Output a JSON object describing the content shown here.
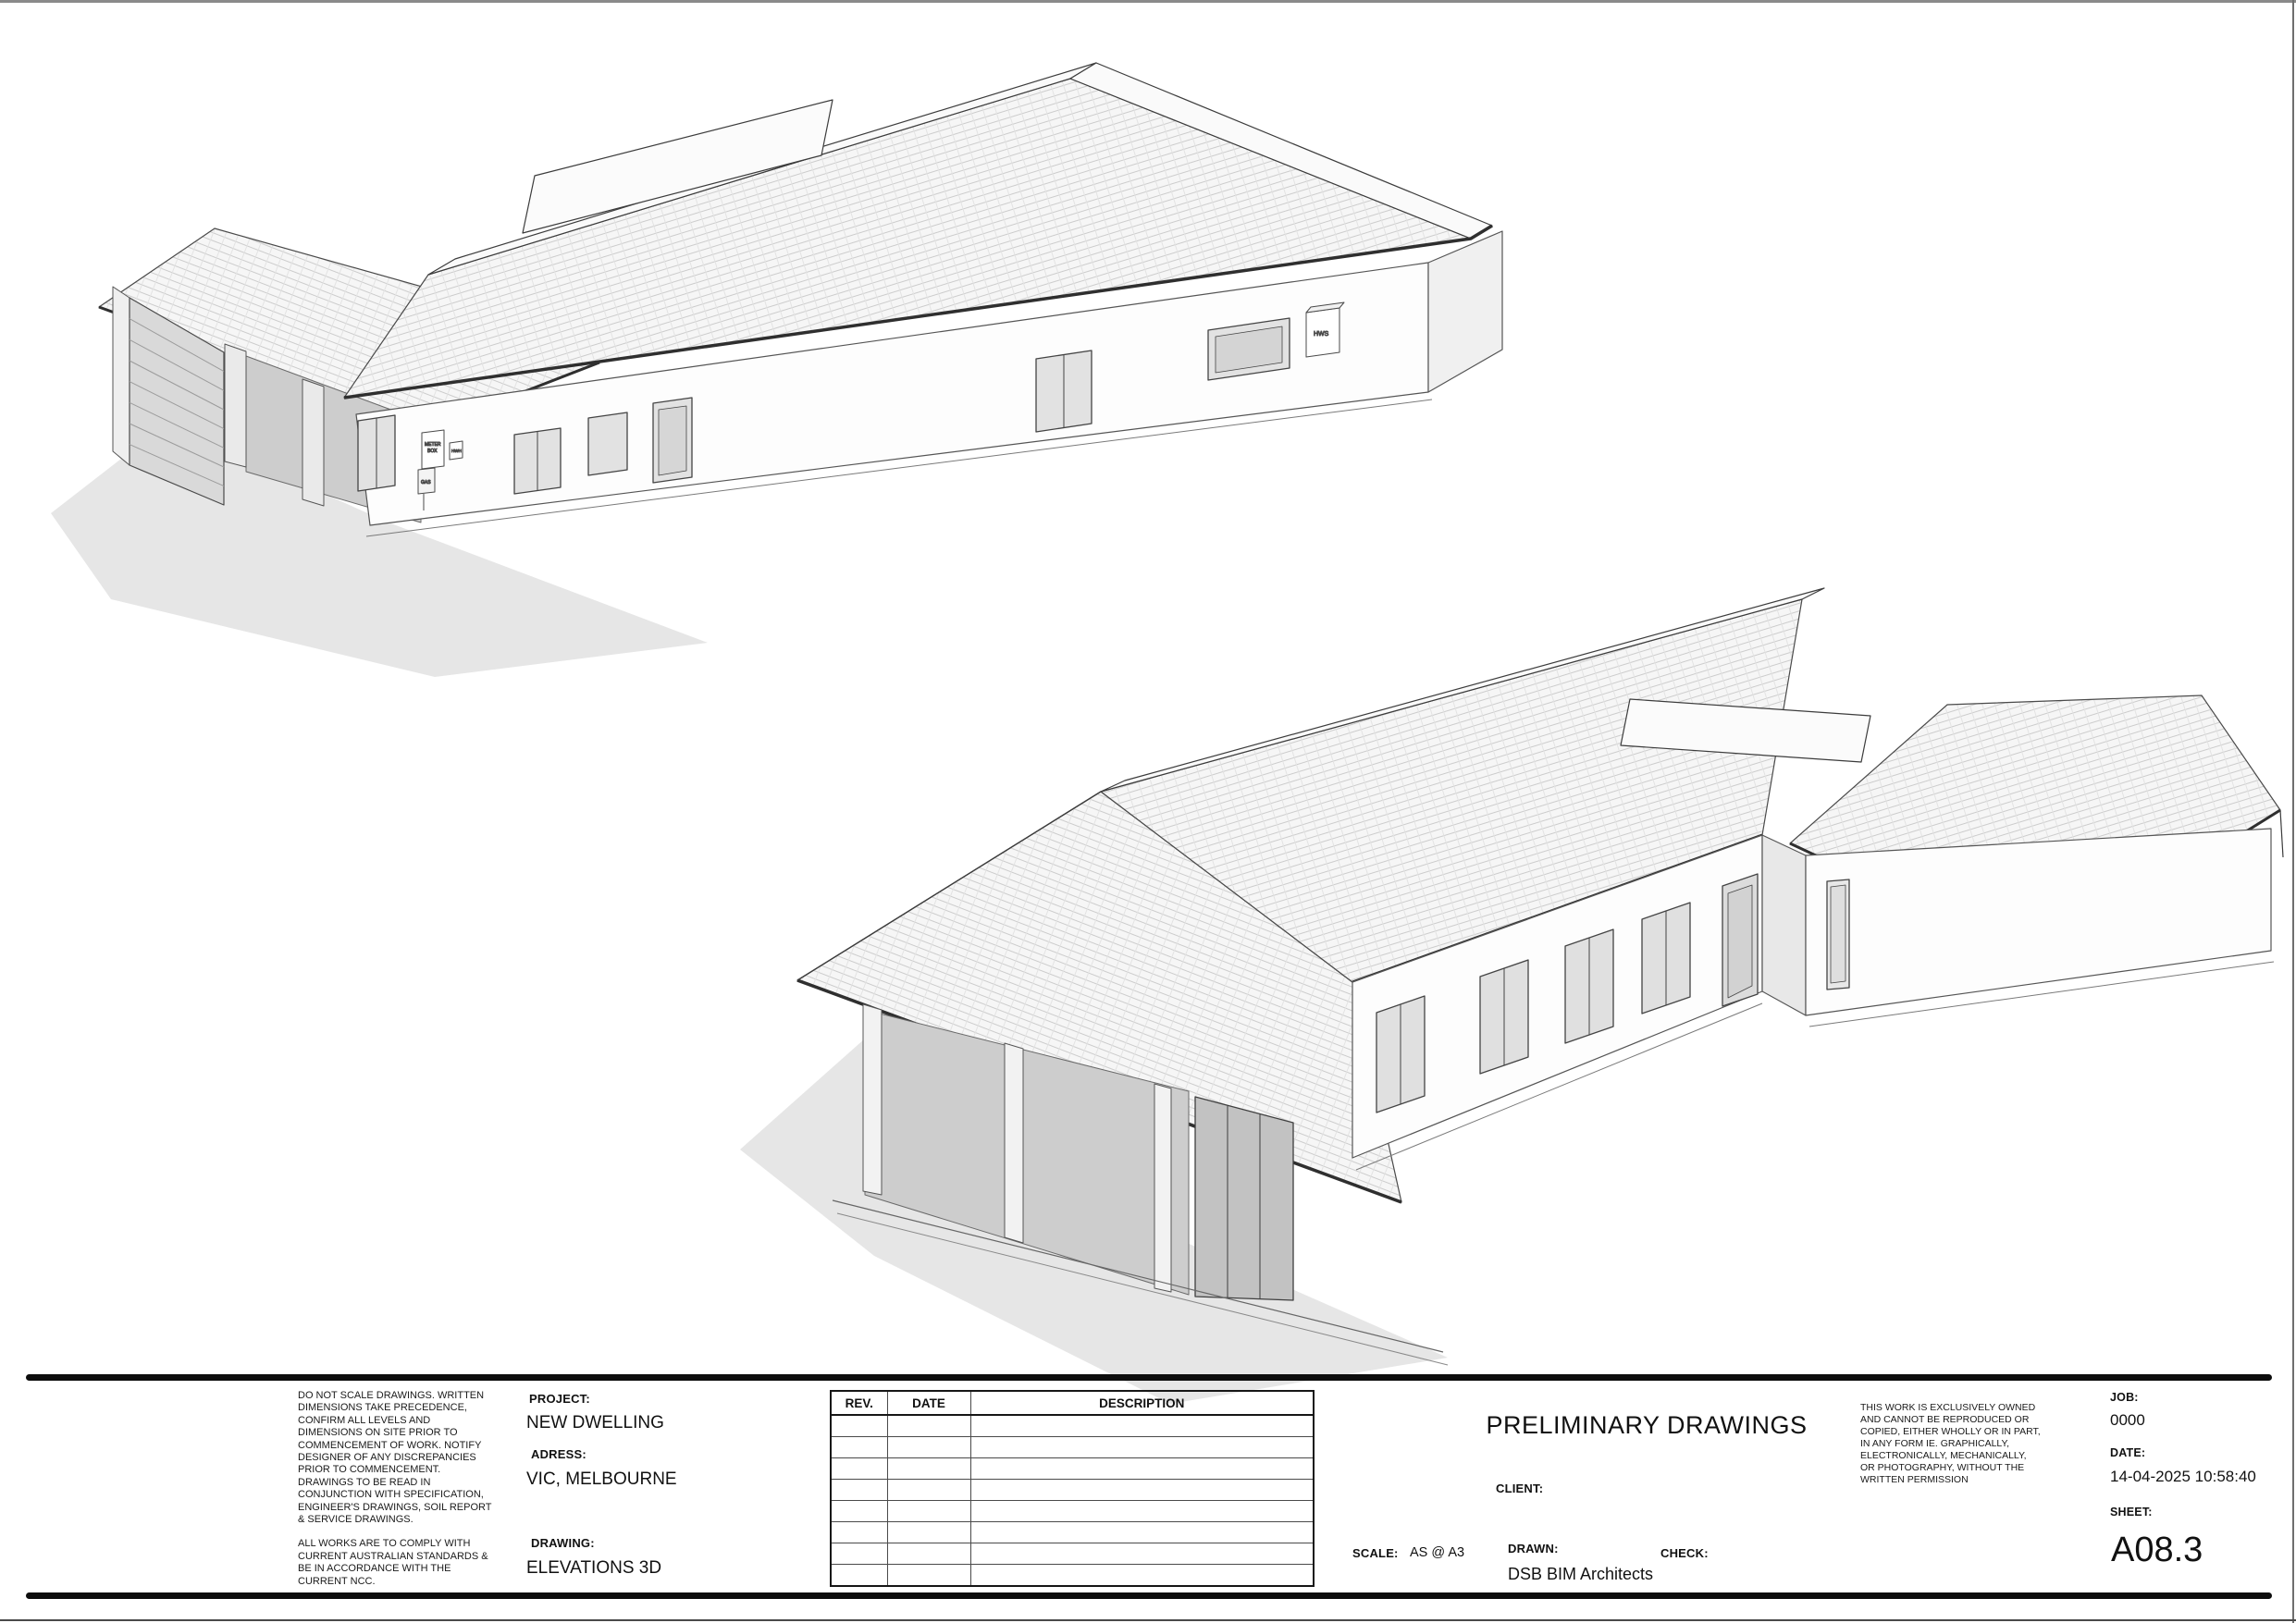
{
  "sheet": {
    "disclaimer": {
      "p1": "DO NOT SCALE DRAWINGS. WRITTEN DIMENSIONS TAKE PRECEDENCE, CONFIRM ALL LEVELS AND DIMENSIONS ON SITE PRIOR TO COMMENCEMENT OF WORK. NOTIFY DESIGNER OF ANY DISCREPANCIES PRIOR TO COMMENCEMENT. DRAWINGS TO BE READ IN CONJUNCTION WITH SPECIFICATION, ENGINEER'S DRAWINGS, SOIL REPORT & SERVICE DRAWINGS.",
      "p2": "ALL WORKS ARE TO COMPLY WITH CURRENT AUSTRALIAN STANDARDS & BE IN ACCORDANCE WITH THE CURRENT NCC."
    },
    "project": {
      "label": "PROJECT:",
      "value": "NEW DWELLING"
    },
    "address": {
      "label": "ADRESS:",
      "value": "VIC, MELBOURNE"
    },
    "drawing": {
      "label": "DRAWING:",
      "value": "ELEVATIONS 3D"
    },
    "revision_table": {
      "headers": [
        "REV.",
        "DATE",
        "DESCRIPTION"
      ],
      "empty_row_count": 8
    },
    "status_title": "PRELIMINARY DRAWINGS",
    "client": {
      "label": "CLIENT:"
    },
    "scale": {
      "label": "SCALE:",
      "value": "AS @ A3"
    },
    "drawn": {
      "label": "DRAWN:",
      "value": "DSB BIM Architects"
    },
    "check": {
      "label": "CHECK:"
    },
    "copyright": "THIS WORK IS EXCLUSIVELY OWNED AND CANNOT BE REPRODUCED OR COPIED, EITHER WHOLLY OR IN PART, IN ANY FORM IE. GRAPHICALLY, ELECTRONICALLY, MECHANICALLY, OR PHOTOGRAPHY, WITHOUT THE WRITTEN PERMISSION",
    "job": {
      "label": "JOB:",
      "value": "0000"
    },
    "date": {
      "label": "DATE:",
      "value": "14-04-2025 10:58:40"
    },
    "sheet_no": {
      "label": "SHEET:",
      "value": "A08.3"
    }
  },
  "drawing_annotations": {
    "meter_box_line1": "METER",
    "meter_box_line2": "BOX",
    "hwh": "HWH",
    "gas": "GAS",
    "hws": "HWS"
  }
}
